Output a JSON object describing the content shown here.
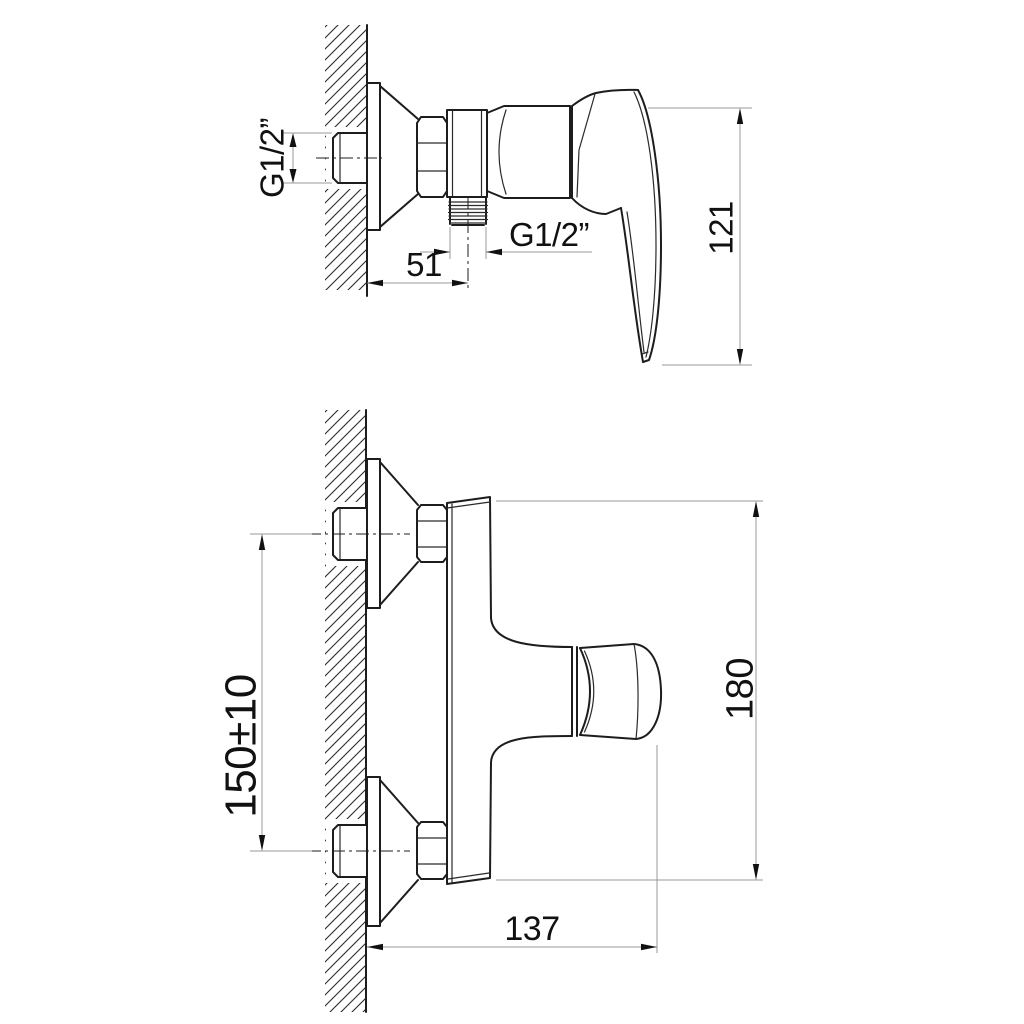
{
  "drawing": {
    "background": "#ffffff",
    "outline_color": "#1d1d1d",
    "dimension_line_color": "#9a9a9a",
    "hatch_color": "#2a2a2a",
    "views": {
      "side": {
        "name": "side-view",
        "labels": {
          "inlet_thread": "G1/2”",
          "wall_to_outlet": "51",
          "outlet_thread": "G1/2”",
          "height": "121"
        }
      },
      "front": {
        "name": "front-view",
        "labels": {
          "inlet_spacing": "150±10",
          "height": "180",
          "depth": "137"
        }
      }
    }
  }
}
